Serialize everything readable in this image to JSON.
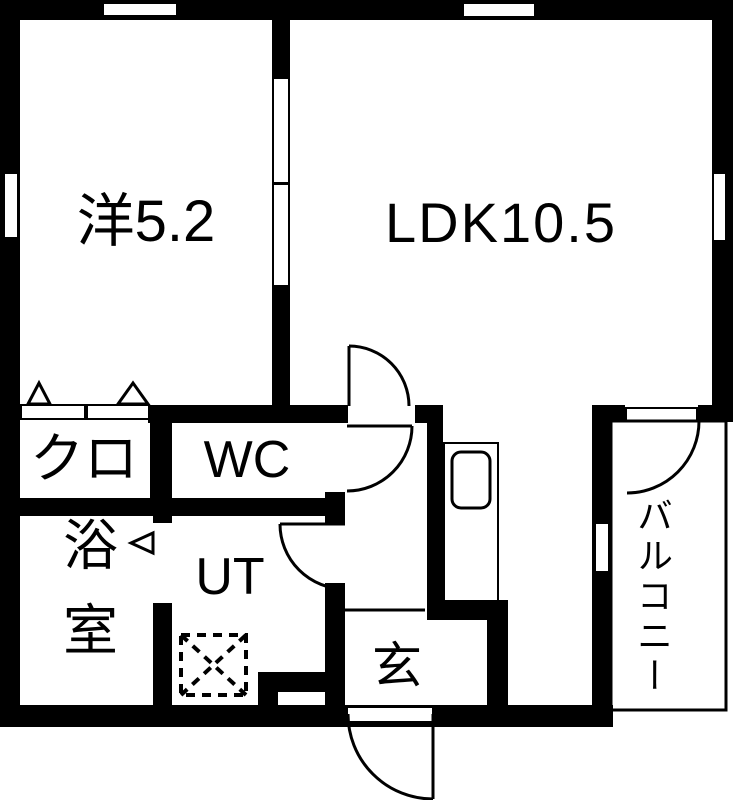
{
  "title": "1LDK floor plan",
  "rooms": {
    "western": {
      "label": "洋5.2"
    },
    "ldk": {
      "label": "LDK10.5"
    },
    "closet": {
      "label": "クロ"
    },
    "wc": {
      "label": "WC"
    },
    "bath": {
      "label": "浴室"
    },
    "utility": {
      "label": "UT"
    },
    "entrance": {
      "label": "玄"
    },
    "balcony": {
      "label": "バルコニー"
    }
  },
  "colors": {
    "wall": "#000000",
    "floor": "#ffffff",
    "line": "#000000"
  }
}
